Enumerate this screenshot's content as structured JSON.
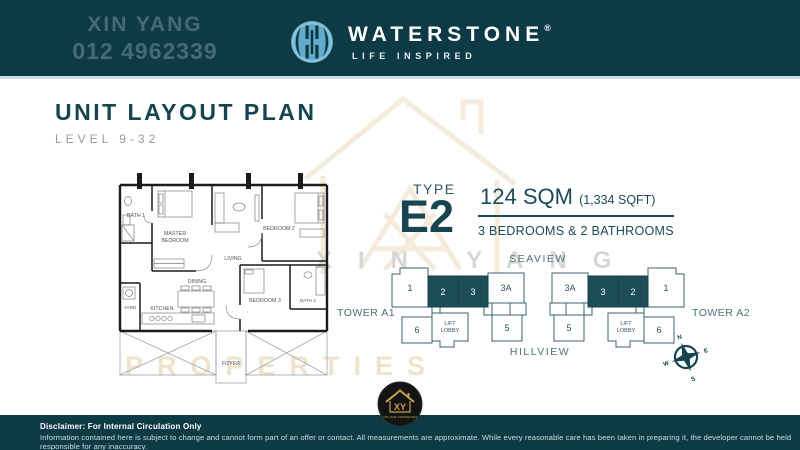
{
  "header": {
    "watermark_name": "XIN YANG",
    "watermark_phone": "012 4962339",
    "brand": "WATERSTONE",
    "brand_mark": "®",
    "tagline": "LIFE INSPIRED"
  },
  "title": {
    "heading": "UNIT LAYOUT PLAN",
    "level": "LEVEL 9-32"
  },
  "unit": {
    "type_label": "TYPE",
    "type_code": "E2",
    "area_sqm": "124 SQM",
    "area_sqft": "(1,334 SQFT)",
    "bedrooms": "3 BEDROOMS & 2 BATHROOMS"
  },
  "floorplan": {
    "bath1": "BATH 1",
    "master_l1": "MASTER",
    "master_l2": "BEDROOM",
    "living": "LIVING",
    "bedroom2": "BEDROOM 2",
    "dining": "DINING",
    "kitchen": "KITCHEN",
    "yard": "YARD",
    "bedroom3": "BEDROOM 3",
    "bath2": "BATH 2",
    "foyer": "FOYER"
  },
  "siteplan": {
    "seaview": "SEAVIEW",
    "hillview": "HILLVIEW",
    "towers": [
      {
        "name": "TOWER A1",
        "top": [
          {
            "label": "1",
            "highlight": false
          },
          {
            "label": "2",
            "highlight": true
          },
          {
            "label": "3",
            "highlight": true
          },
          {
            "label": "3A",
            "highlight": false
          }
        ],
        "bottom": [
          {
            "label": "6"
          },
          {
            "label_l1": "LIFT",
            "label_l2": "LOBBY"
          },
          {
            "label": "5"
          }
        ]
      },
      {
        "name": "TOWER A2",
        "top": [
          {
            "label": "3A",
            "highlight": false
          },
          {
            "label": "3",
            "highlight": true
          },
          {
            "label": "2",
            "highlight": true
          },
          {
            "label": "1",
            "highlight": false
          }
        ],
        "bottom": [
          {
            "label": "5"
          },
          {
            "label_l1": "LIFT",
            "label_l2": "LOBBY"
          },
          {
            "label": "6"
          }
        ]
      }
    ],
    "compass": {
      "n": "N",
      "e": "E",
      "s": "S",
      "w": "W"
    }
  },
  "watermarks": {
    "tiled_name": "XIN YANG",
    "tiled_word": "PROPERTIES"
  },
  "badge": {
    "monogram": "XY",
    "caption": "XIN YANG PROPERTIES"
  },
  "footer": {
    "line1": "Disclaimer: For Internal Circulation Only",
    "line2": "Information contained here is subject to change and cannot form part of an offer or contact. All measurements are approximate. While every reasonable care has been taken in preparing it, the developer cannot be held responsible for any inaccuracy."
  },
  "colors": {
    "header_bg": "#0e3a45",
    "separator": "#c7dde8",
    "accent_teal": "#16454f",
    "unit_highlight": "#1d4d58",
    "subtitle_gray": "#97999b",
    "logo_blue": "#63abc8",
    "badge_gold": "#c9a14a"
  }
}
